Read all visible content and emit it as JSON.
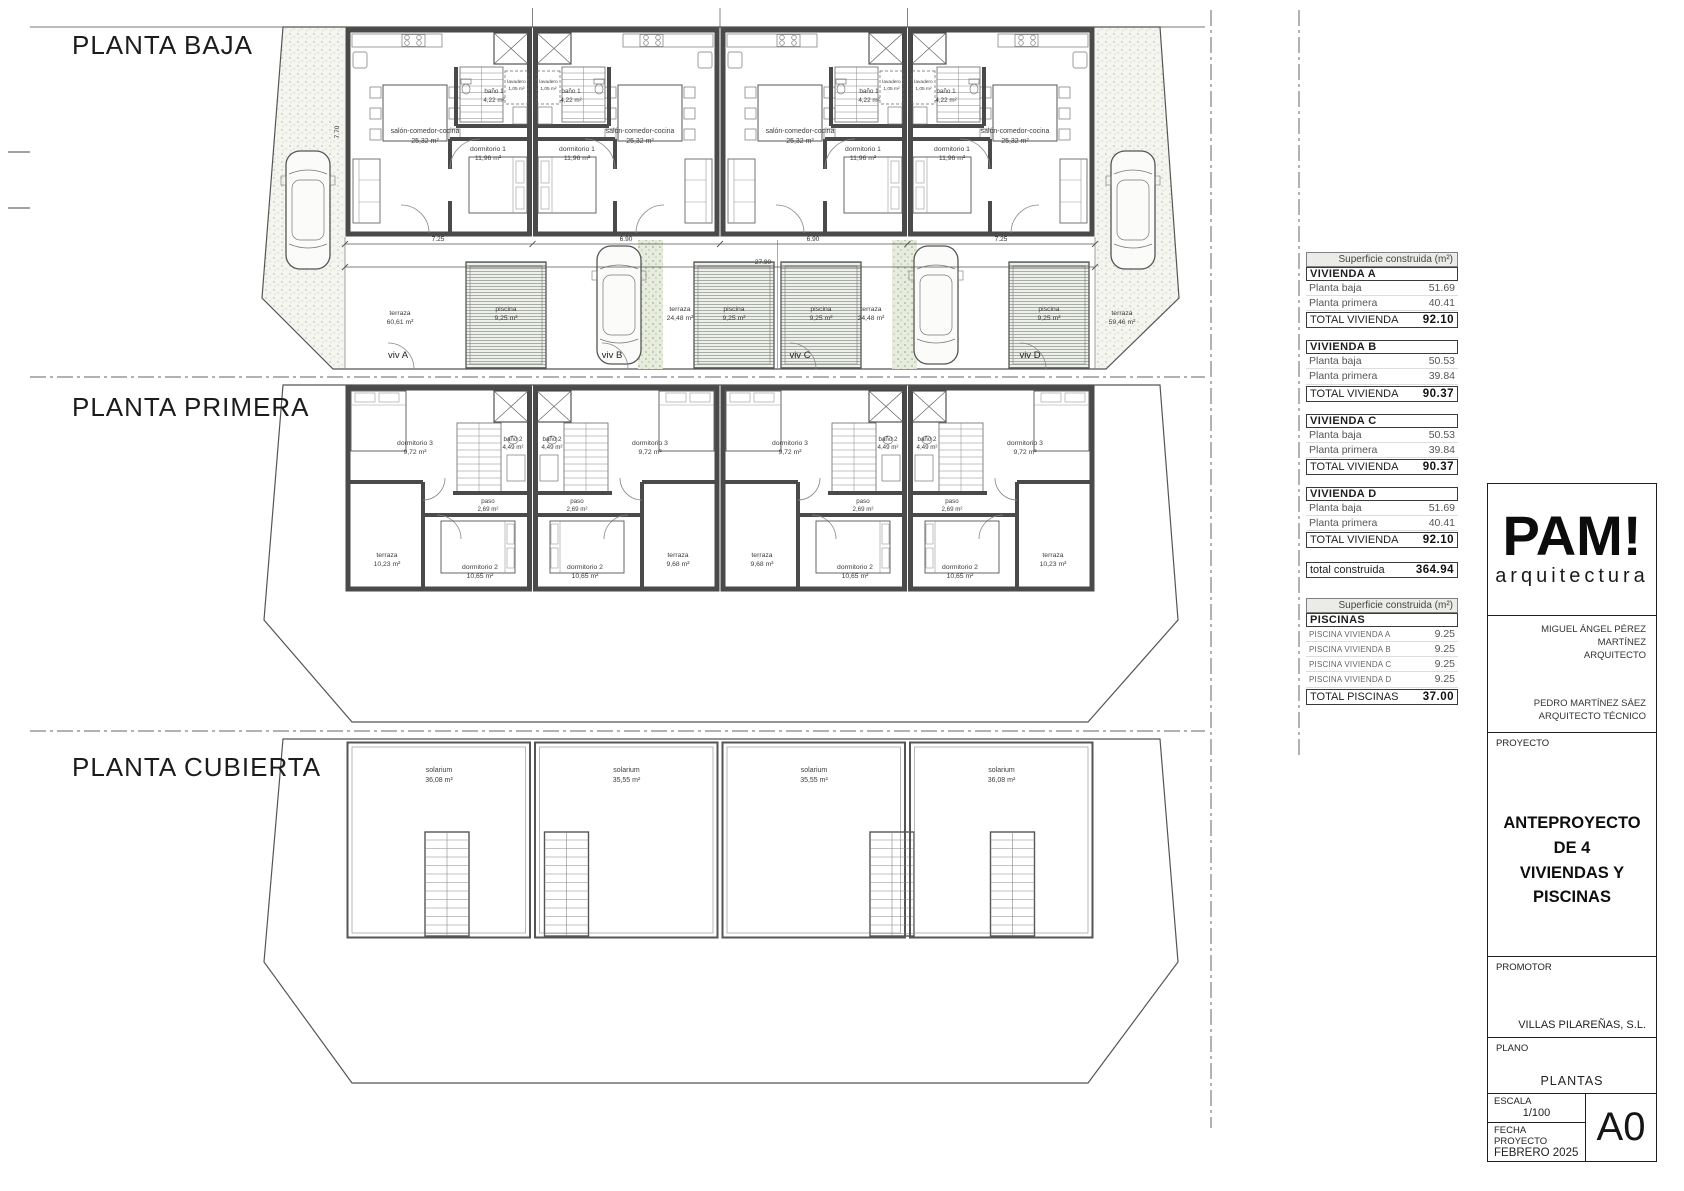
{
  "plan_titles": {
    "baja": "PLANTA BAJA",
    "primera": "PLANTA PRIMERA",
    "cubierta": "PLANTA CUBIERTA"
  },
  "baja": {
    "room_salon": "salón-comedor-cocina",
    "salon_area": "25,32 m²",
    "room_dorm1": "dormitorio 1",
    "dorm1_area": "11,96 m²",
    "room_bano1": "baño 1",
    "bano1_area": "4,22 m²",
    "room_lavadero": "lavadero",
    "lavadero_area": "1,05 m²",
    "terraza_label": "terraza",
    "terrazas": [
      "60,61 m²",
      "24,48 m²",
      "24,48 m²",
      "59,46 m²"
    ],
    "piscina_label": "piscina",
    "piscina_area": "9,25 m²",
    "viv": [
      "viv A",
      "viv B",
      "viv C",
      "viv D"
    ],
    "dims": {
      "seg": [
        "7.25",
        "6.90",
        "6.90",
        "7.25"
      ],
      "total": "27.90",
      "side": "7.70"
    }
  },
  "primera": {
    "room_dorm3": "dormitorio 3",
    "dorm3_area": "9,72 m²",
    "room_bano2": "baño 2",
    "bano2_area": "4,49 m²",
    "room_paso": "paso",
    "paso_area": "2,69 m²",
    "room_terraza": "terraza",
    "terraza_areas": [
      "10,23 m²",
      "9,68 m²",
      "9,68 m²",
      "10,23 m²"
    ],
    "room_dorm2": "dormitorio 2",
    "dorm2_area": "10,65 m²"
  },
  "cubierta": {
    "room_solarium": "solarium",
    "solarium_areas": [
      "36,08 m²",
      "35,55 m²",
      "35,55 m²",
      "36,08 m²"
    ]
  },
  "tables": {
    "header": "Superficie construida (m²)",
    "viviendas": [
      {
        "name": "VIVIENDA A",
        "rows": [
          [
            "Planta baja",
            "51.69"
          ],
          [
            "Planta primera",
            "40.41"
          ]
        ],
        "total_label": "TOTAL VIVIENDA",
        "total": "92.10"
      },
      {
        "name": "VIVIENDA B",
        "rows": [
          [
            "Planta baja",
            "50.53"
          ],
          [
            "Planta primera",
            "39.84"
          ]
        ],
        "total_label": "TOTAL VIVIENDA",
        "total": "90.37"
      },
      {
        "name": "VIVIENDA C",
        "rows": [
          [
            "Planta baja",
            "50.53"
          ],
          [
            "Planta primera",
            "39.84"
          ]
        ],
        "total_label": "TOTAL VIVIENDA",
        "total": "90.37"
      },
      {
        "name": "VIVIENDA D",
        "rows": [
          [
            "Planta baja",
            "51.69"
          ],
          [
            "Planta primera",
            "40.41"
          ]
        ],
        "total_label": "TOTAL VIVIENDA",
        "total": "92.10"
      }
    ],
    "total_construida_label": "total construida",
    "total_construida": "364.94",
    "piscinas": {
      "title": "PISCINAS",
      "rows": [
        [
          "PISCINA VIVIENDA A",
          "9.25"
        ],
        [
          "PISCINA VIVIENDA B",
          "9.25"
        ],
        [
          "PISCINA VIVIENDA C",
          "9.25"
        ],
        [
          "PISCINA VIVIENDA D",
          "9.25"
        ]
      ],
      "total_label": "TOTAL PISCINAS",
      "total": "37.00"
    }
  },
  "titleblock": {
    "logo_main": "PAM!",
    "logo_sub": "arquitectura",
    "architect1_name": "MIGUEL ÁNGEL PÉREZ MARTÍNEZ",
    "architect1_role": "ARQUITECTO",
    "architect2_name": "PEDRO MARTÍNEZ SÁEZ",
    "architect2_role": "ARQUITECTO TÉCNICO",
    "proyecto_label": "PROYECTO",
    "proyecto_line1": "ANTEPROYECTO DE  4",
    "proyecto_line2": "VIVIENDAS Y PISCINAS",
    "promotor_label": "PROMOTOR",
    "promotor_value": "VILLAS PILAREÑAS, S.L.",
    "plano_label": "PLANO",
    "plano_value": "PLANTAS",
    "escala_label": "ESCALA",
    "escala_value": "1/100",
    "fecha_label": "FECHA PROYECTO",
    "fecha_value": "FEBRERO 2025",
    "formato": "A0"
  }
}
